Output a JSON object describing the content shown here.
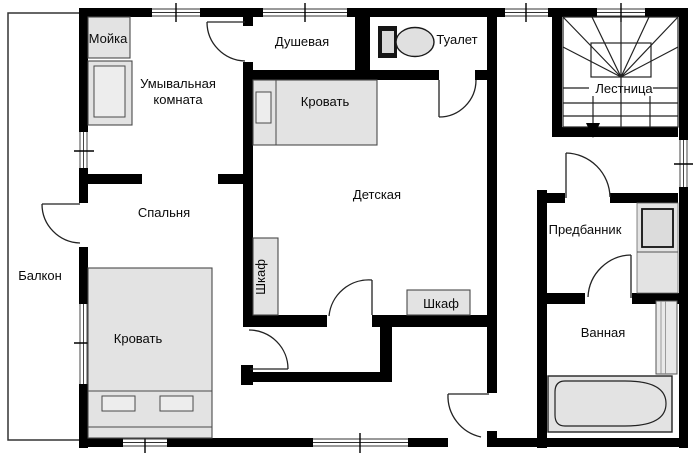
{
  "plan": {
    "colors": {
      "background": "#ffffff",
      "wall": "#000000",
      "thin_line": "#222222",
      "furniture_fill": "#e3e3e3",
      "text": "#0a0a0a"
    },
    "rooms": {
      "balcony": {
        "label": "Балкон"
      },
      "washroom": {
        "label_line1": "Умывальная",
        "label_line2": "комната"
      },
      "shower": {
        "label": "Душевая"
      },
      "toilet": {
        "label": "Туалет"
      },
      "bedroom": {
        "label": "Спальня"
      },
      "nursery": {
        "label": "Детская"
      },
      "stairs": {
        "label": "Лестница"
      },
      "anteroom": {
        "label": "Предбанник"
      },
      "bathroom": {
        "label": "Ванная"
      }
    },
    "furniture": {
      "sink": {
        "label": "Мойка"
      },
      "nursery_bed": {
        "label": "Кровать"
      },
      "bedroom_bed": {
        "label": "Кровать"
      },
      "nursery_wardrobe_side": {
        "label": "Шкаф"
      },
      "nursery_wardrobe_bottom": {
        "label": "Шкаф"
      }
    }
  }
}
